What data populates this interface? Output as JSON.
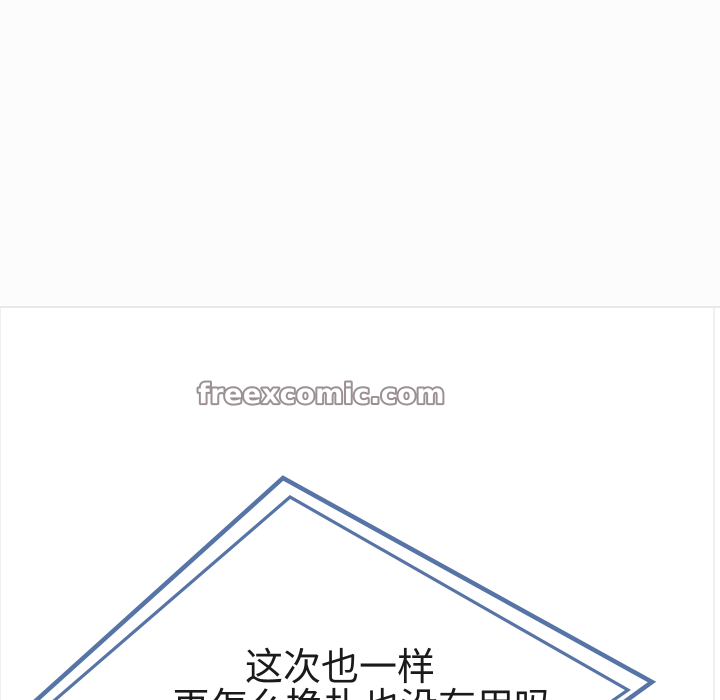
{
  "watermark": {
    "text": "freexcomic.com",
    "fill_color": "#ffffff",
    "outline_color": "#9c8f96"
  },
  "dialogue": {
    "line1": "这次也一样",
    "line2_partial": "再怎么挣扎也没有用吗",
    "line2_clipped_at_bottom": true,
    "text_color": "#1a1a1a"
  },
  "panel": {
    "background": "#ffffff",
    "border_color": "#e9e9e9"
  },
  "diamond_frame": {
    "stroke_color": "#5674a6",
    "style": "double-outlined rotated square, partially visible",
    "outer_points": "30,706 283,478 652,682 616,708",
    "inner_points": "48,706 290,497 628,690 602,708"
  }
}
